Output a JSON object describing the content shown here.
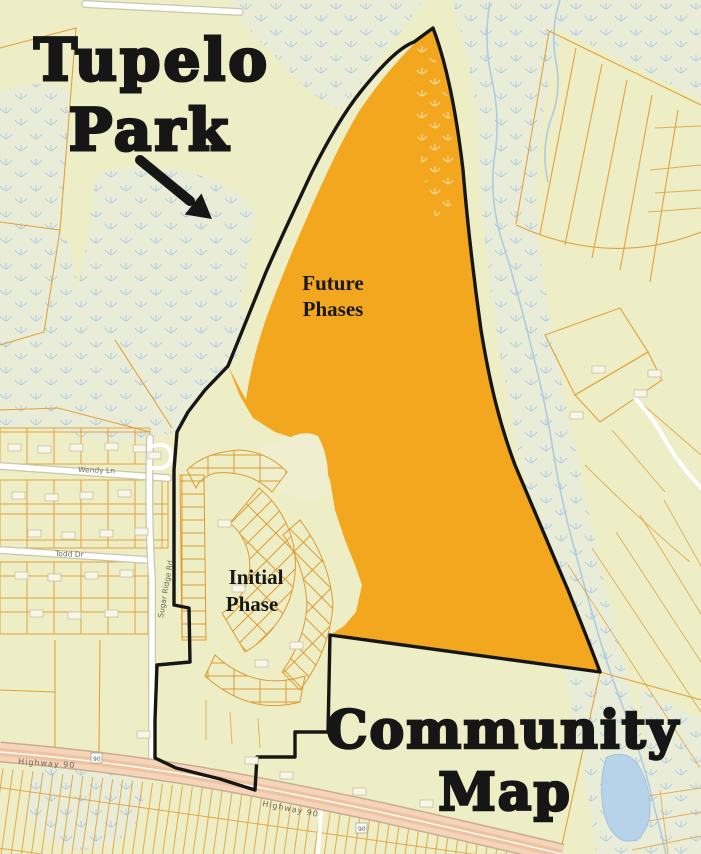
{
  "title": {
    "line1": "Tupelo",
    "line2": "Park"
  },
  "labels": {
    "future_line1": "Future",
    "future_line2": "Phases",
    "initial_line1": "Initial",
    "initial_line2": "Phase",
    "community_line1": "Community",
    "community_line2": "Map"
  },
  "streets": {
    "wendy": "Wendy Ln",
    "todd": "Todd Dr",
    "sugar_ridge": "Sugar Ridge Rd",
    "highway_left": "Highway 90",
    "highway_right": "Highway 90",
    "shield_left": "90",
    "shield_right": "90"
  },
  "colors": {
    "map_bg": "#EDEDC6",
    "region": "#F2A71E",
    "boundary": "#161616",
    "parcel_line": "#E2A23B",
    "wetland_bg": "#E9EDD8",
    "marsh_symbol": "#A9C9E5",
    "water": "#A6C7E2",
    "pond": "#B7D3E9",
    "road_fill": "#FFFFFF",
    "highway_fill": "#F4D4BA",
    "title_text": "#161616",
    "street_text": "#6E6E60"
  }
}
